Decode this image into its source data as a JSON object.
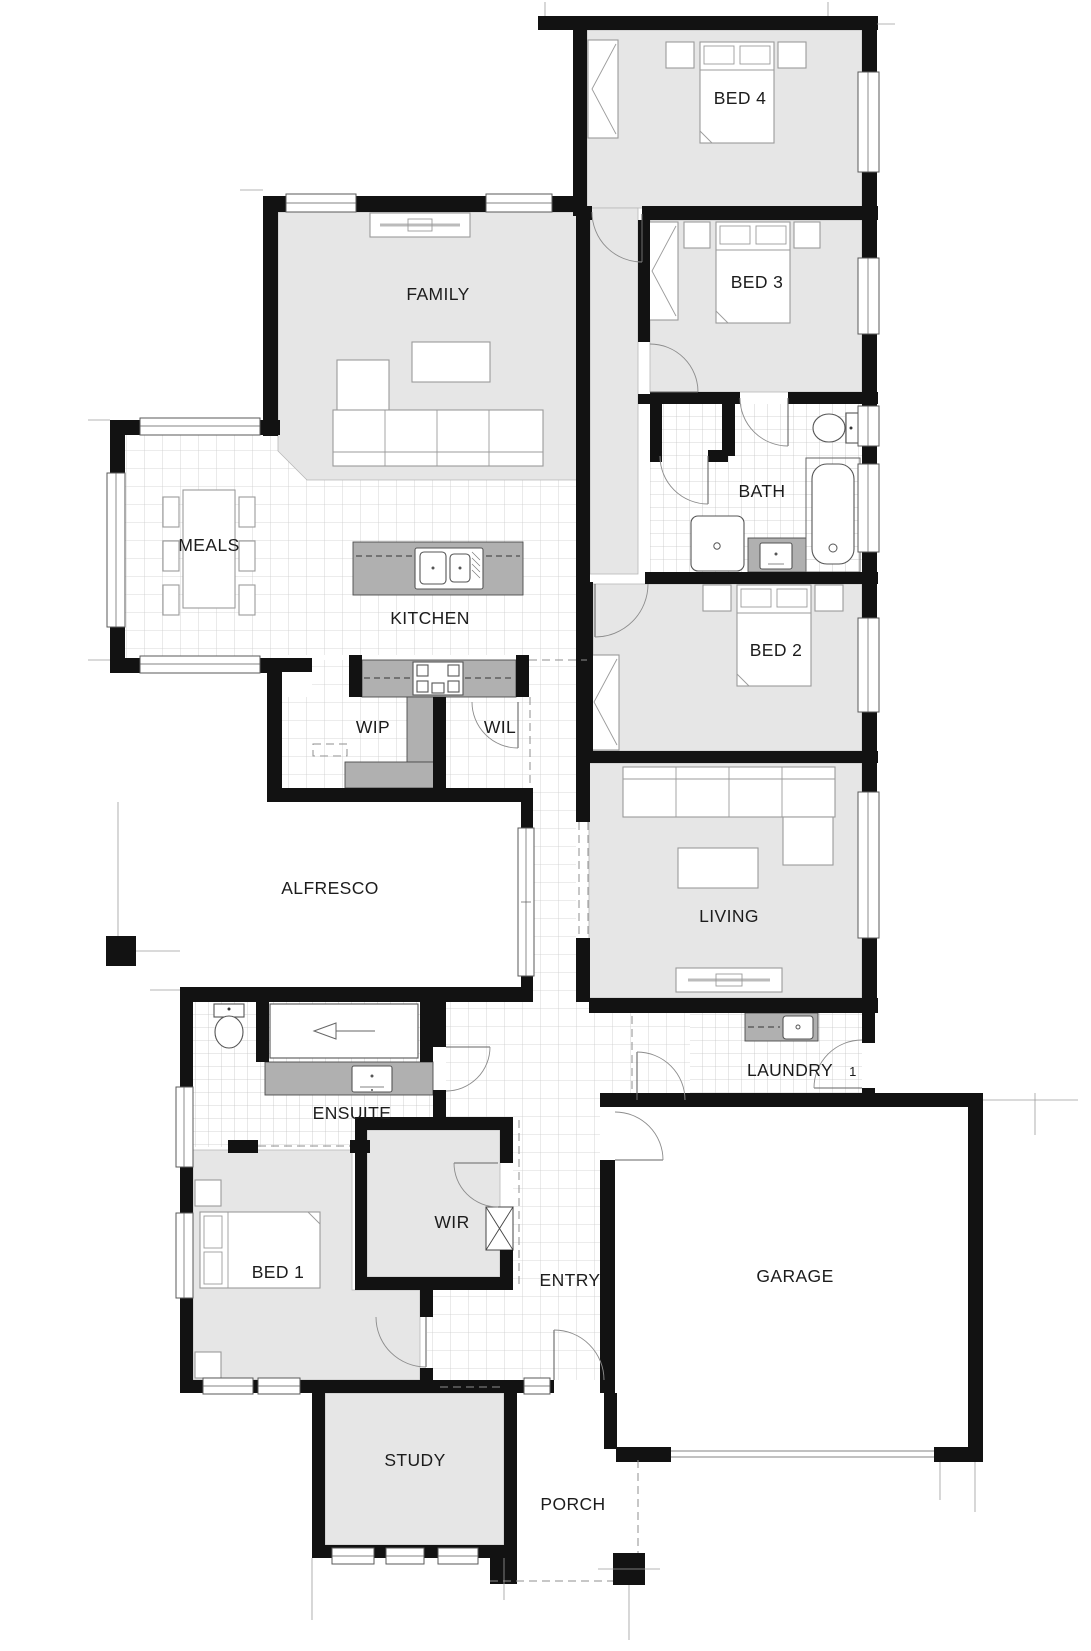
{
  "title": "House Floor Plan",
  "colors": {
    "wall": "#121212",
    "carpet": "#e6e6e6",
    "bench": "#b0b0b0",
    "tile_line": "#cccccc",
    "label": "#1c1c1c",
    "background": "#ffffff"
  },
  "rooms": [
    {
      "id": "bed4",
      "label": "BED 4",
      "x": 740,
      "y": 104
    },
    {
      "id": "bed3",
      "label": "BED 3",
      "x": 757,
      "y": 288
    },
    {
      "id": "bath",
      "label": "BATH",
      "x": 762,
      "y": 497
    },
    {
      "id": "bed2",
      "label": "BED 2",
      "x": 776,
      "y": 656
    },
    {
      "id": "family",
      "label": "FAMILY",
      "x": 438,
      "y": 300
    },
    {
      "id": "meals",
      "label": "MEALS",
      "x": 209,
      "y": 551
    },
    {
      "id": "kitchen",
      "label": "KITCHEN",
      "x": 430,
      "y": 624
    },
    {
      "id": "wip",
      "label": "WIP",
      "x": 373,
      "y": 733
    },
    {
      "id": "wil",
      "label": "WIL",
      "x": 500,
      "y": 733
    },
    {
      "id": "alfresco",
      "label": "ALFRESCO",
      "x": 330,
      "y": 894
    },
    {
      "id": "living",
      "label": "LIVING",
      "x": 729,
      "y": 922
    },
    {
      "id": "laundry",
      "label": "LAUNDRY",
      "x": 790,
      "y": 1076
    },
    {
      "id": "ensuite",
      "label": "ENSUITE",
      "x": 352,
      "y": 1119
    },
    {
      "id": "wir",
      "label": "WIR",
      "x": 452,
      "y": 1228
    },
    {
      "id": "bed1",
      "label": "BED 1",
      "x": 278,
      "y": 1278
    },
    {
      "id": "entry",
      "label": "ENTRY",
      "x": 570,
      "y": 1286
    },
    {
      "id": "garage",
      "label": "GARAGE",
      "x": 795,
      "y": 1282
    },
    {
      "id": "study",
      "label": "STUDY",
      "x": 415,
      "y": 1466
    },
    {
      "id": "porch",
      "label": "PORCH",
      "x": 573,
      "y": 1510
    }
  ],
  "annotations": [
    {
      "id": "door-number-1",
      "label": "1",
      "x": 853,
      "y": 1076
    }
  ]
}
